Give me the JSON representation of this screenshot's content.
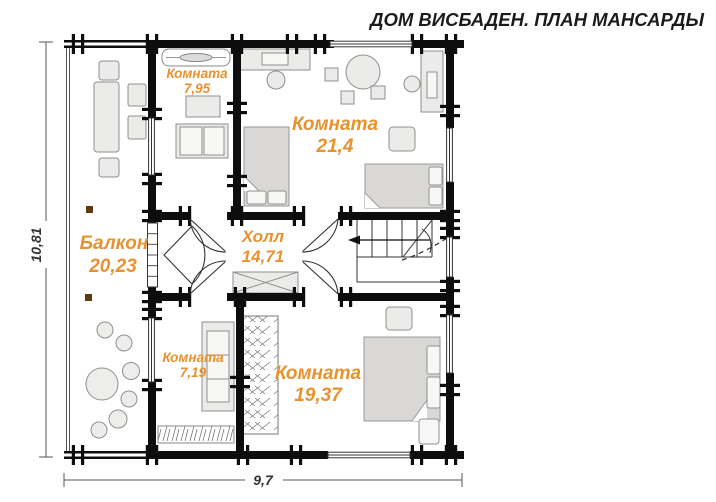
{
  "title": "ДОМ ВИСБАДЕН. ПЛАН МАНСАРДЫ",
  "colors": {
    "room_label": "#e8922f",
    "walls": "#0d0d0d",
    "dimension_text": "#333333",
    "balcony_post": "#5a3c0e"
  },
  "rooms": {
    "room_795": {
      "name": "Комната",
      "area": "7,95"
    },
    "room_214": {
      "name": "Комната",
      "area": "21,4"
    },
    "balcony": {
      "name": "Балкон",
      "area": "20,23"
    },
    "hall": {
      "name": "Холл",
      "area": "14,71"
    },
    "room_719": {
      "name": "Комната",
      "area": "7,19"
    },
    "room_1937": {
      "name": "Комната",
      "area": "19,37"
    }
  },
  "dimensions": {
    "overall_width_m": "9,7",
    "overall_height_m": "10,81"
  }
}
